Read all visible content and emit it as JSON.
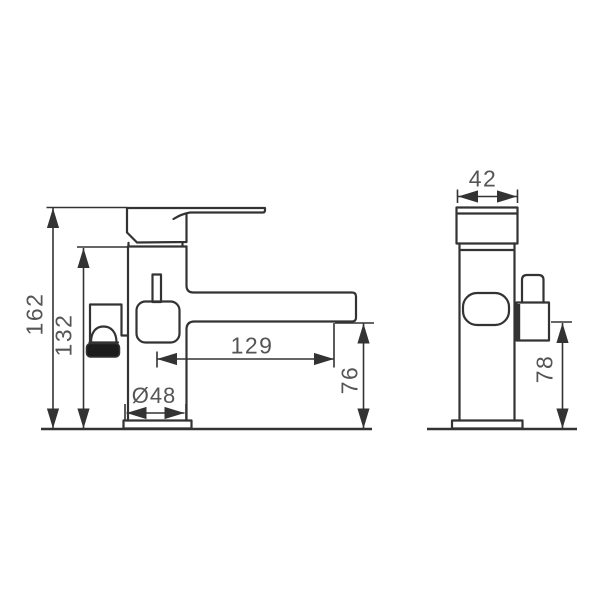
{
  "colors": {
    "line": "#333333",
    "text": "#555555",
    "dark_fill": "#1c1c1c",
    "background": "#ffffff"
  },
  "dimensions": {
    "front_view": {
      "total_height": "162",
      "body_height": "132",
      "spout_reach": "129",
      "base_diameter": "Ø48",
      "spout_height": "76"
    },
    "side_view": {
      "body_width": "42",
      "spray_outlet_height": "78"
    }
  }
}
